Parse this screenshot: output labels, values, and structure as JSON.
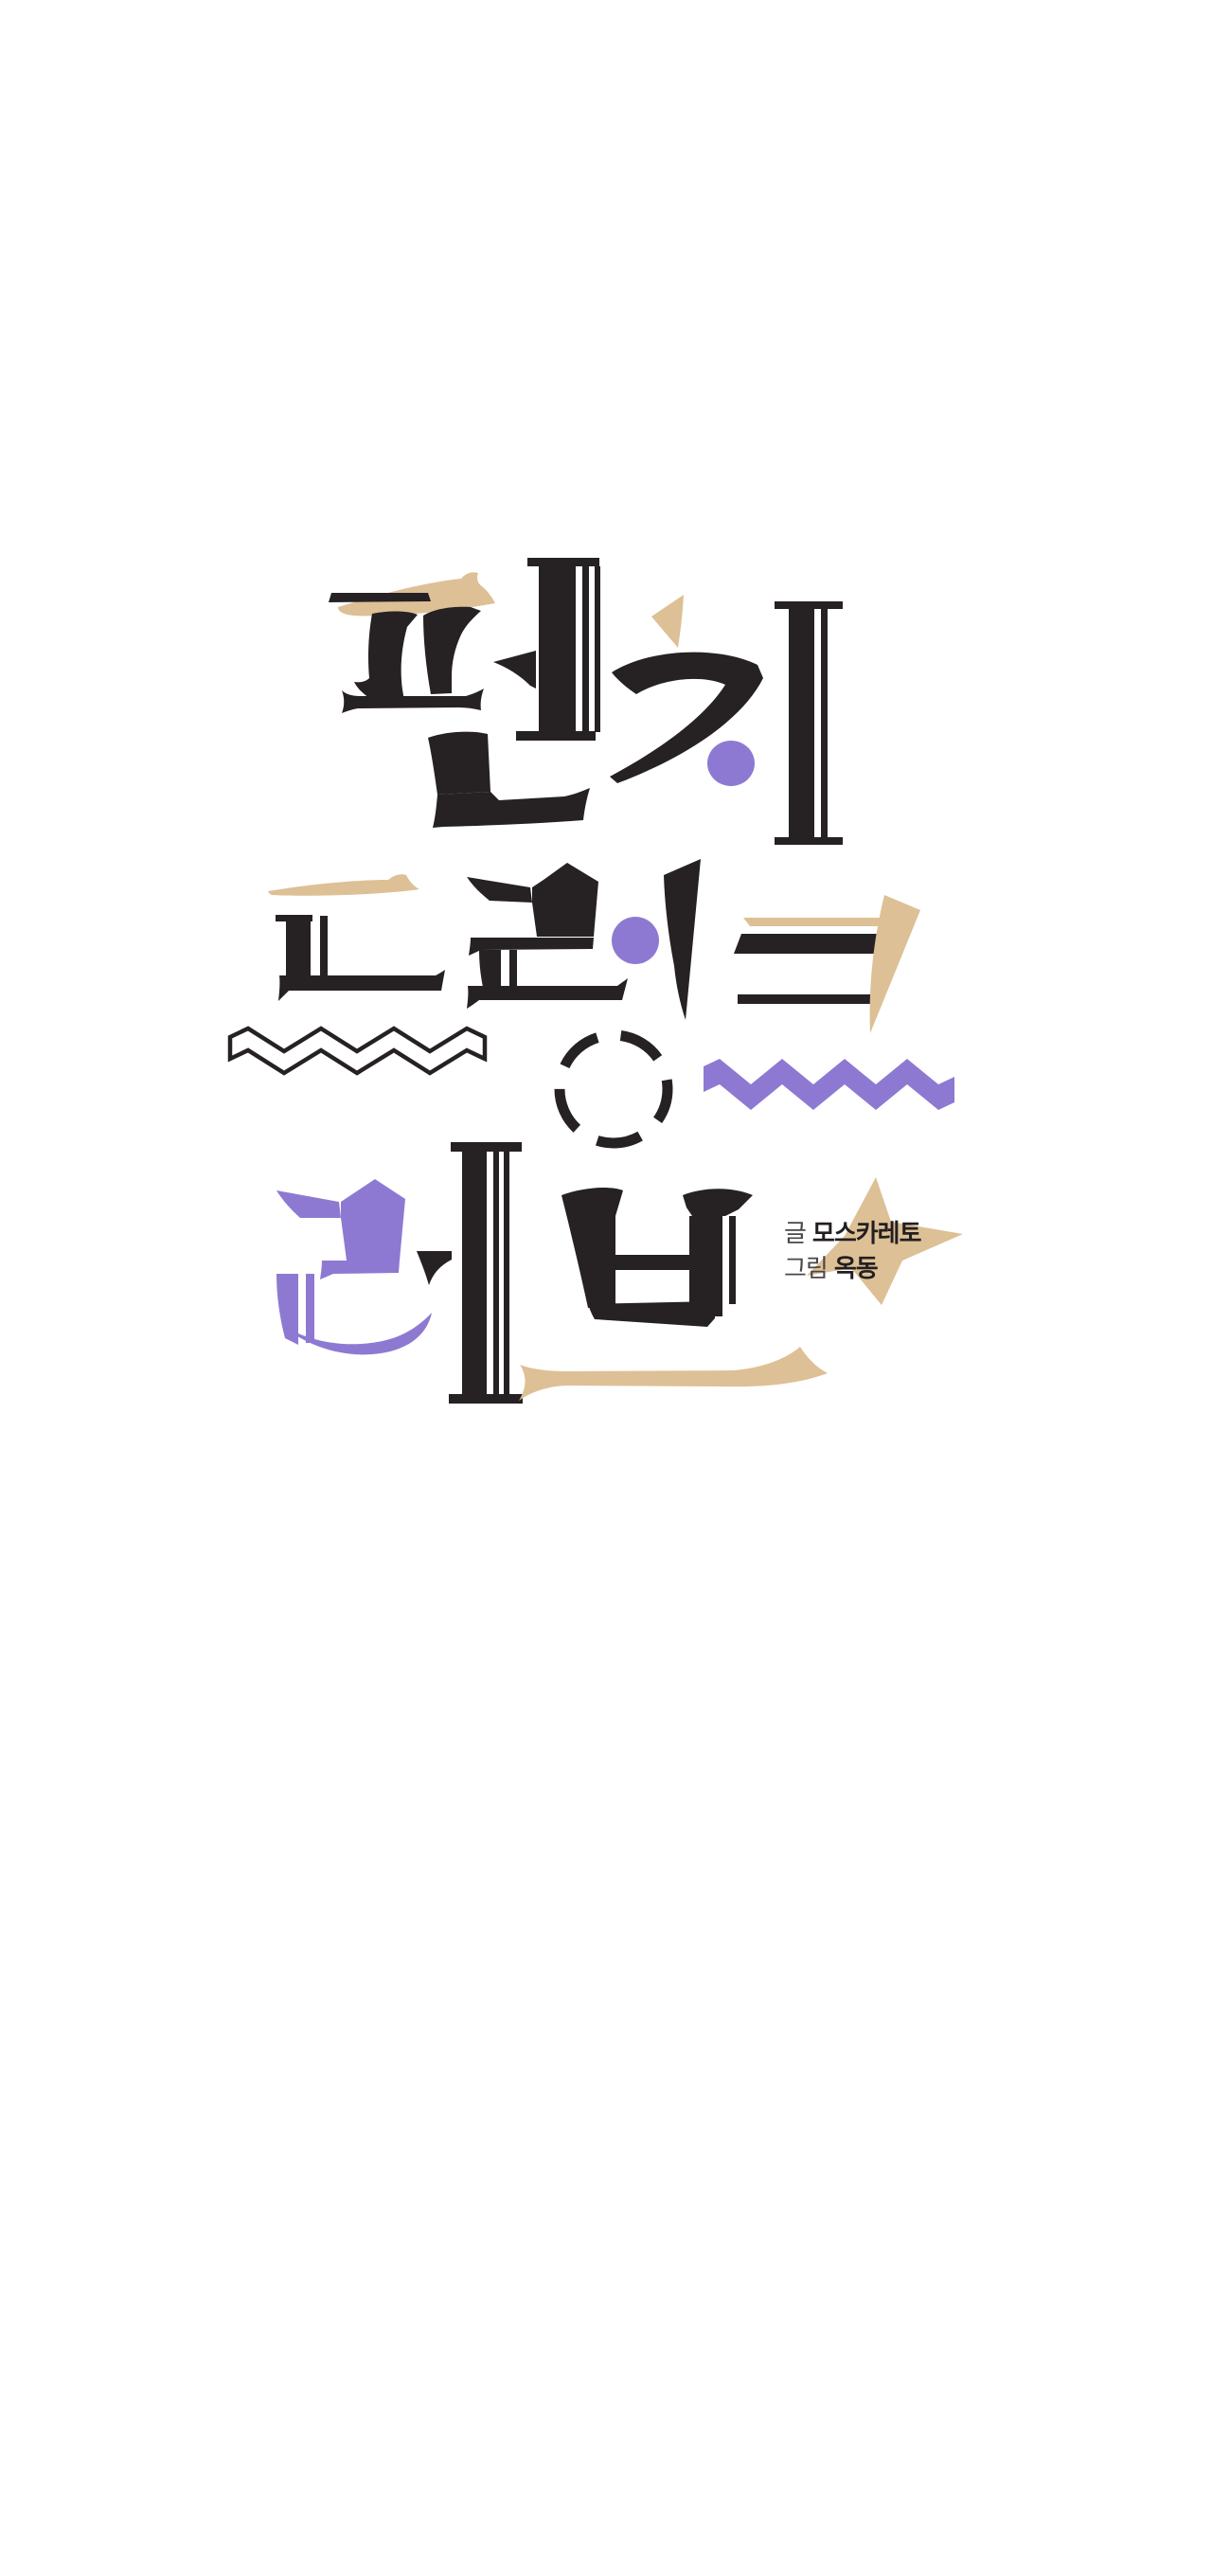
{
  "page": {
    "kind": "webtoon-title-splash",
    "background": "#ffffff"
  },
  "logo": {
    "title": "펀치 드렁크 러브",
    "words": [
      {
        "text": "펀치",
        "row": 1
      },
      {
        "text": "드렁크",
        "row": 2
      },
      {
        "text": "러브",
        "row": 3
      }
    ]
  },
  "credits": {
    "writer_label": "글",
    "writer_name": "모스카레토",
    "artist_label": "그림",
    "artist_name": "옥동"
  },
  "colors": {
    "ink": "#262123",
    "purple": "#8e79d2",
    "tan": "#ddc095",
    "credit_label": "#4b4647",
    "credit_name": "#231f20",
    "background": "#ffffff"
  },
  "decorations": [
    "tan-swoosh",
    "tan-triangle",
    "tan-star",
    "tan-underline",
    "purple-dot",
    "purple-zigzag",
    "black-zigzag-outline",
    "dashed-circle"
  ]
}
